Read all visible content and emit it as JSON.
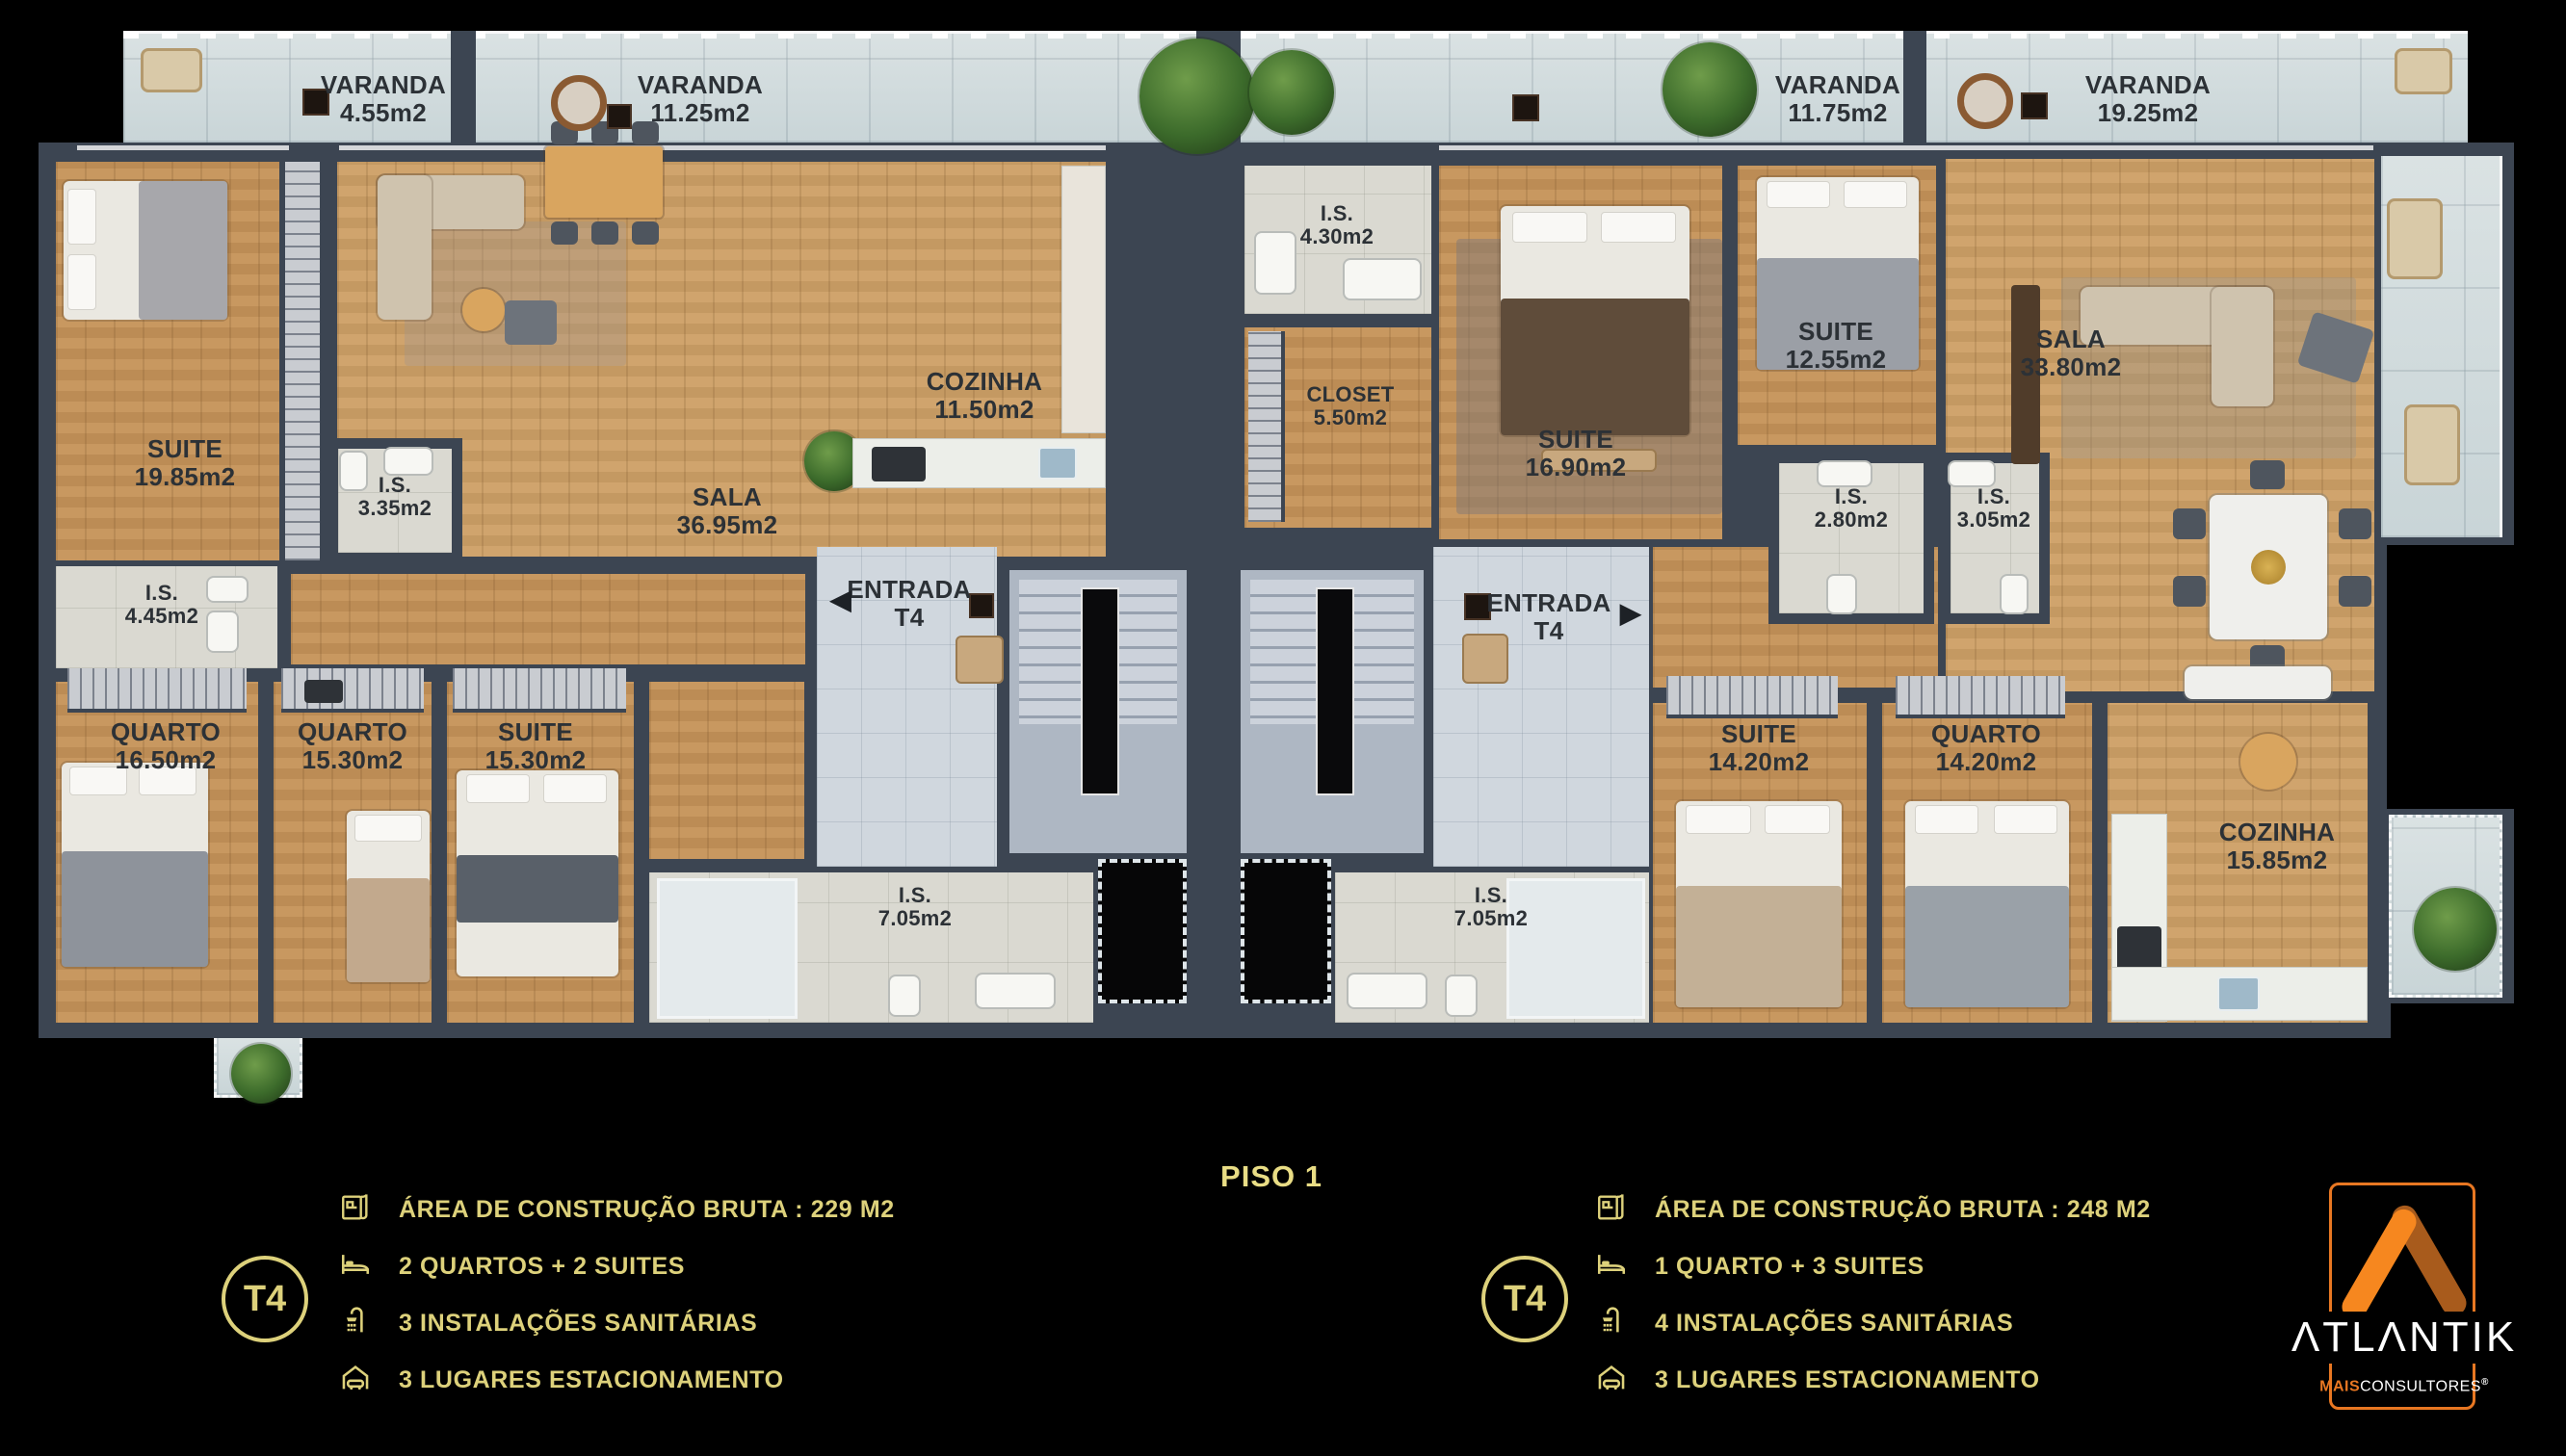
{
  "floor": {
    "label": "PISO 1"
  },
  "varandas": [
    {
      "name": "VARANDA",
      "area": "4.55m2"
    },
    {
      "name": "VARANDA",
      "area": "11.25m2"
    },
    {
      "name": "VARANDA",
      "area": "11.75m2"
    },
    {
      "name": "VARANDA",
      "area": "19.25m2"
    }
  ],
  "unit_left": {
    "entrance": {
      "name": "ENTRADA",
      "unit": "T4",
      "arrow": "◀"
    },
    "rooms": [
      {
        "name": "SUITE",
        "area": "19.85m2"
      },
      {
        "name": "I.S.",
        "area": "4.45m2"
      },
      {
        "name": "I.S.",
        "area": "3.35m2"
      },
      {
        "name": "SALA",
        "area": "36.95m2"
      },
      {
        "name": "COZINHA",
        "area": "11.50m2"
      },
      {
        "name": "QUARTO",
        "area": "16.50m2"
      },
      {
        "name": "QUARTO",
        "area": "15.30m2"
      },
      {
        "name": "SUITE",
        "area": "15.30m2"
      },
      {
        "name": "I.S.",
        "area": "7.05m2"
      }
    ],
    "legend": {
      "unit_type": "T4",
      "items": [
        {
          "icon": "floorplan-icon",
          "label": "ÁREA DE CONSTRUÇÃO BRUTA :  229 M2"
        },
        {
          "icon": "bed-icon",
          "label": "2 QUARTOS + 2 SUITES"
        },
        {
          "icon": "shower-icon",
          "label": "3 INSTALAÇÕES SANITÁRIAS"
        },
        {
          "icon": "garage-icon",
          "label": "3 LUGARES ESTACIONAMENTO"
        }
      ]
    }
  },
  "unit_right": {
    "entrance": {
      "name": "ENTRADA",
      "unit": "T4",
      "arrow": "▶"
    },
    "rooms": [
      {
        "name": "I.S.",
        "area": "4.30m2"
      },
      {
        "name": "CLOSET",
        "area": "5.50m2"
      },
      {
        "name": "SUITE",
        "area": "16.90m2"
      },
      {
        "name": "SUITE",
        "area": "12.55m2"
      },
      {
        "name": "I.S.",
        "area": "2.80m2"
      },
      {
        "name": "I.S.",
        "area": "3.05m2"
      },
      {
        "name": "SALA",
        "area": "33.80m2"
      },
      {
        "name": "SUITE",
        "area": "14.20m2"
      },
      {
        "name": "QUARTO",
        "area": "14.20m2"
      },
      {
        "name": "COZINHA",
        "area": "15.85m2"
      },
      {
        "name": "I.S.",
        "area": "7.05m2"
      }
    ],
    "legend": {
      "unit_type": "T4",
      "items": [
        {
          "icon": "floorplan-icon",
          "label": "ÁREA DE CONSTRUÇÃO BRUTA :  248 M2"
        },
        {
          "icon": "bed-icon",
          "label": "1 QUARTO + 3 SUITES"
        },
        {
          "icon": "shower-icon",
          "label": "4 INSTALAÇÕES SANITÁRIAS"
        },
        {
          "icon": "garage-icon",
          "label": "3 LUGARES ESTACIONAMENTO"
        }
      ]
    }
  },
  "logo": {
    "brand": "ATLANTIK",
    "brand_display": "ΛTLΛNTIK",
    "tagline_bold": "MAIS",
    "tagline_rest": "CONSULTORES",
    "registered": "®"
  },
  "colors": {
    "accent_gold": "#ddd17b",
    "logo_orange": "#e87722",
    "wall": "#3c4552"
  }
}
